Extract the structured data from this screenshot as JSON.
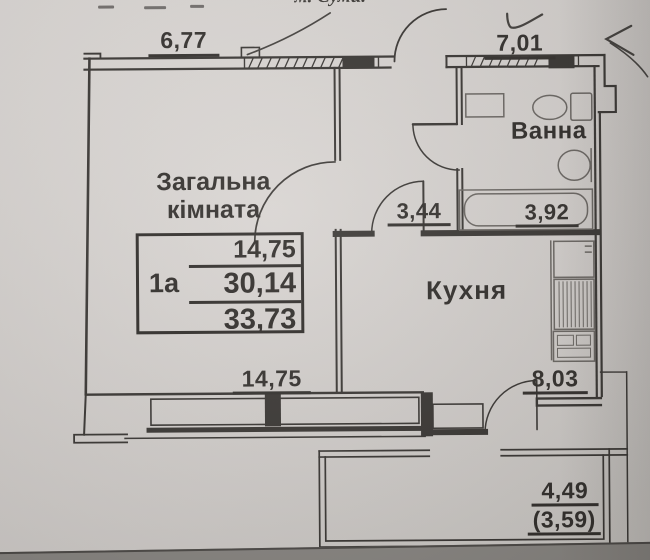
{
  "document": {
    "top_text_fragment": "м. Суми."
  },
  "plan": {
    "unit_table": {
      "unit_label": "1а",
      "rows": [
        "14,75",
        "30,14",
        "33,73"
      ]
    },
    "rooms": {
      "living": {
        "line1": "Загальна",
        "line2": "кімната"
      },
      "bathroom": "Ванна",
      "kitchen": "Кухня"
    },
    "dimensions": {
      "living_top": "6,77",
      "bath_top": "7,01",
      "hall_area": "3,44",
      "bath_area": "3,92",
      "living_bottom": "14,75",
      "kitchen_area": "8,03",
      "balcony_area": "4,49",
      "balcony_area_reduced": "(3,59)"
    }
  },
  "colors": {
    "paper": "#d8d4d1",
    "ink": "#3a3734",
    "fixture": "#6b6763",
    "pen_mark": "#45423f"
  }
}
